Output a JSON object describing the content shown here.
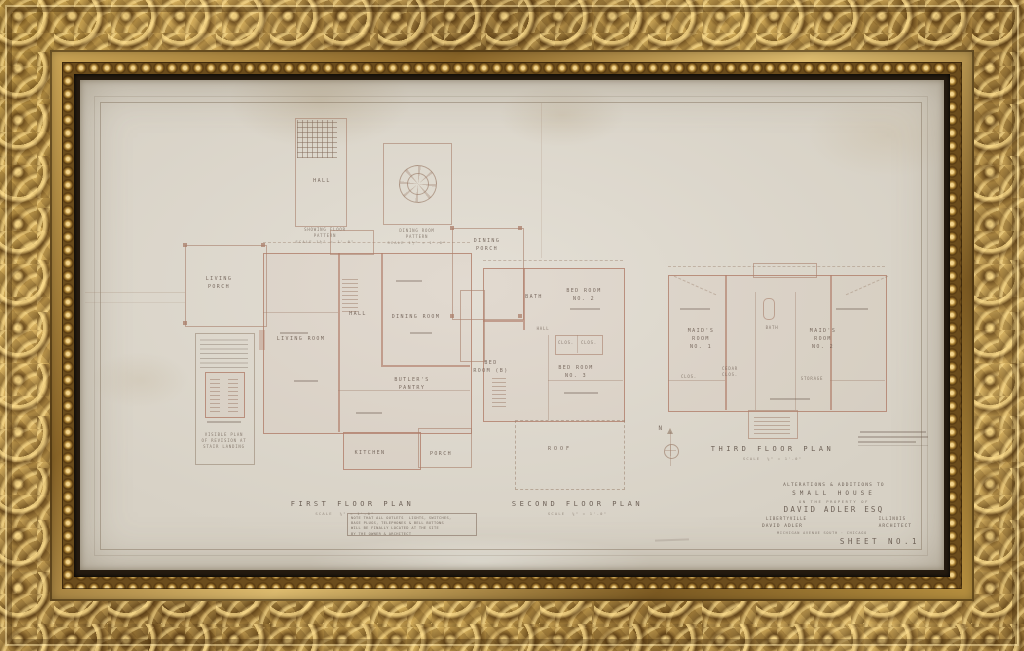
{
  "sheet": {
    "patterns": {
      "hall_room": "HALL",
      "hall_caption": {
        "l1": "SHOWING FLOOR",
        "l2": "PATTERN",
        "l3": "SCALE 1½\" = 1'-0\""
      },
      "dining_caption": {
        "l1": "DINING ROOM",
        "l2": "PATTERN",
        "l3": "SCALE 1½\" = 1'-0\""
      }
    },
    "first_floor": {
      "title": "FIRST FLOOR PLAN",
      "scale": "SCALE  ¼\" = 1'-0\"",
      "rooms": {
        "living_porch": "LIVING\nPORCH",
        "living_room": "LIVING ROOM",
        "hall": "HALL",
        "dining_room": "DINING ROOM",
        "dining_porch": "DINING\nPORCH",
        "butlers_pantry": "BUTLER'S\nPANTRY",
        "kitchen": "KITCHEN",
        "porch": "PORCH"
      },
      "note": {
        "l1": "NOTE THAT ALL OUTLETS  LIGHTS, SWITCHES,",
        "l2": "BASE PLUGS, TELEPHONES & BELL BUTTONS",
        "l3": "WILL BE FINALLY LOCATED AT THE SITE",
        "l4": "BY THE OWNER & ARCHITECT"
      },
      "stair_note": "VISIBLE PLAN\nOF REVISION AT\nSTAIR LANDING"
    },
    "second_floor": {
      "title": "SECOND FLOOR PLAN",
      "scale": "SCALE  ¼\" = 1'-0\"",
      "rooms": {
        "bath": "BATH",
        "bed_2": "BED ROOM\nNO. 2",
        "bed_b": "BED\nROOM (B)",
        "bed_3": "BED ROOM\nNO. 3",
        "hall": "HALL",
        "clos_a": "CLOS.",
        "clos_b": "CLOS.",
        "roof": "ROOF"
      }
    },
    "third_floor": {
      "title": "THIRD FLOOR PLAN",
      "scale": "SCALE  ¼\" = 1'-0\"",
      "rooms": {
        "maid_1": "MAID'S\nROOM\nNO. 1",
        "bath": "BATH",
        "maid_2": "MAID'S\nROOM\nNO. 2",
        "cedar": "CEDAR\nCLOS.",
        "clos": "CLOS.",
        "storage": "STORAGE"
      },
      "compass": "N"
    },
    "title_block": {
      "line1": "ALTERATIONS & ADDITIONS TO",
      "line2": "SMALL HOUSE",
      "line3": "ON THE PROPERTY OF",
      "line4": "DAVID ADLER ESQ",
      "city_left": "LIBERTYVILLE",
      "city_right": "ILLINOIS",
      "arch_left": "DAVID ADLER",
      "arch_right": "ARCHITECT",
      "address": "MICHIGAN AVENUE SOUTH · CHICAGO",
      "sheet_no": "SHEET NO.1"
    },
    "colors": {
      "frame_gold": "#c9a24e",
      "paper": "#d7d1c5",
      "wall_ink": "#b07e6a",
      "text_ink": "#68584d"
    }
  }
}
